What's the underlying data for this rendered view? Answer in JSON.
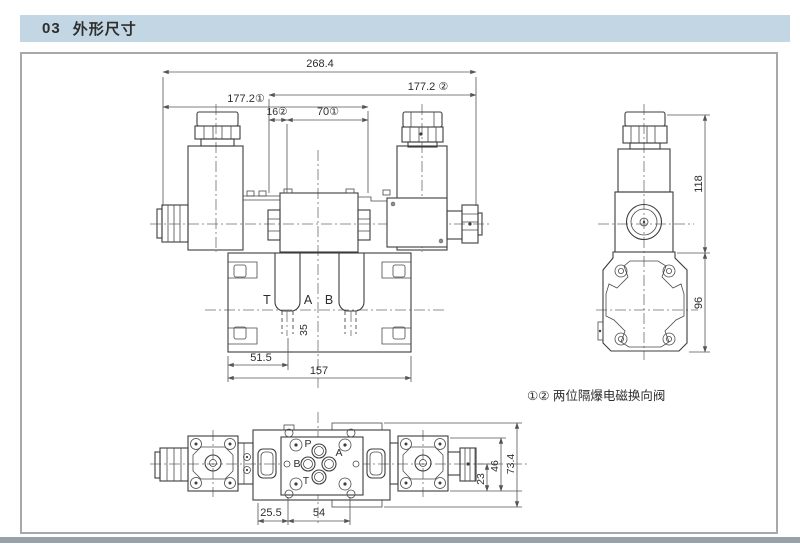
{
  "header": {
    "number": "03",
    "title": "外形尺寸"
  },
  "note": "①② 两位隔爆电磁换向阀",
  "front_view": {
    "dims": {
      "overall_width": "268.4",
      "width_to_sol2": "177.2 ②",
      "width_to_sol1": "177.2①",
      "offset_16": "16②",
      "offset_70": "70①",
      "port_height": "35",
      "base_offset": "51.5",
      "base_width": "157"
    },
    "ports": {
      "t": "T",
      "a": "A",
      "b": "B"
    }
  },
  "side_view": {
    "dims": {
      "upper_height": "118",
      "lower_height": "96"
    }
  },
  "bottom_view": {
    "dims": {
      "offset_25_5": "25.5",
      "spacing_54": "54",
      "height_23": "23",
      "height_46": "46",
      "height_73_4": "73.4"
    },
    "ports": {
      "p": "P",
      "a": "A",
      "b": "B",
      "t": "T"
    }
  },
  "colors": {
    "header_bg": "#c3d6e3",
    "line": "#3d3d3d",
    "frame_border": "#a8a8a8"
  }
}
